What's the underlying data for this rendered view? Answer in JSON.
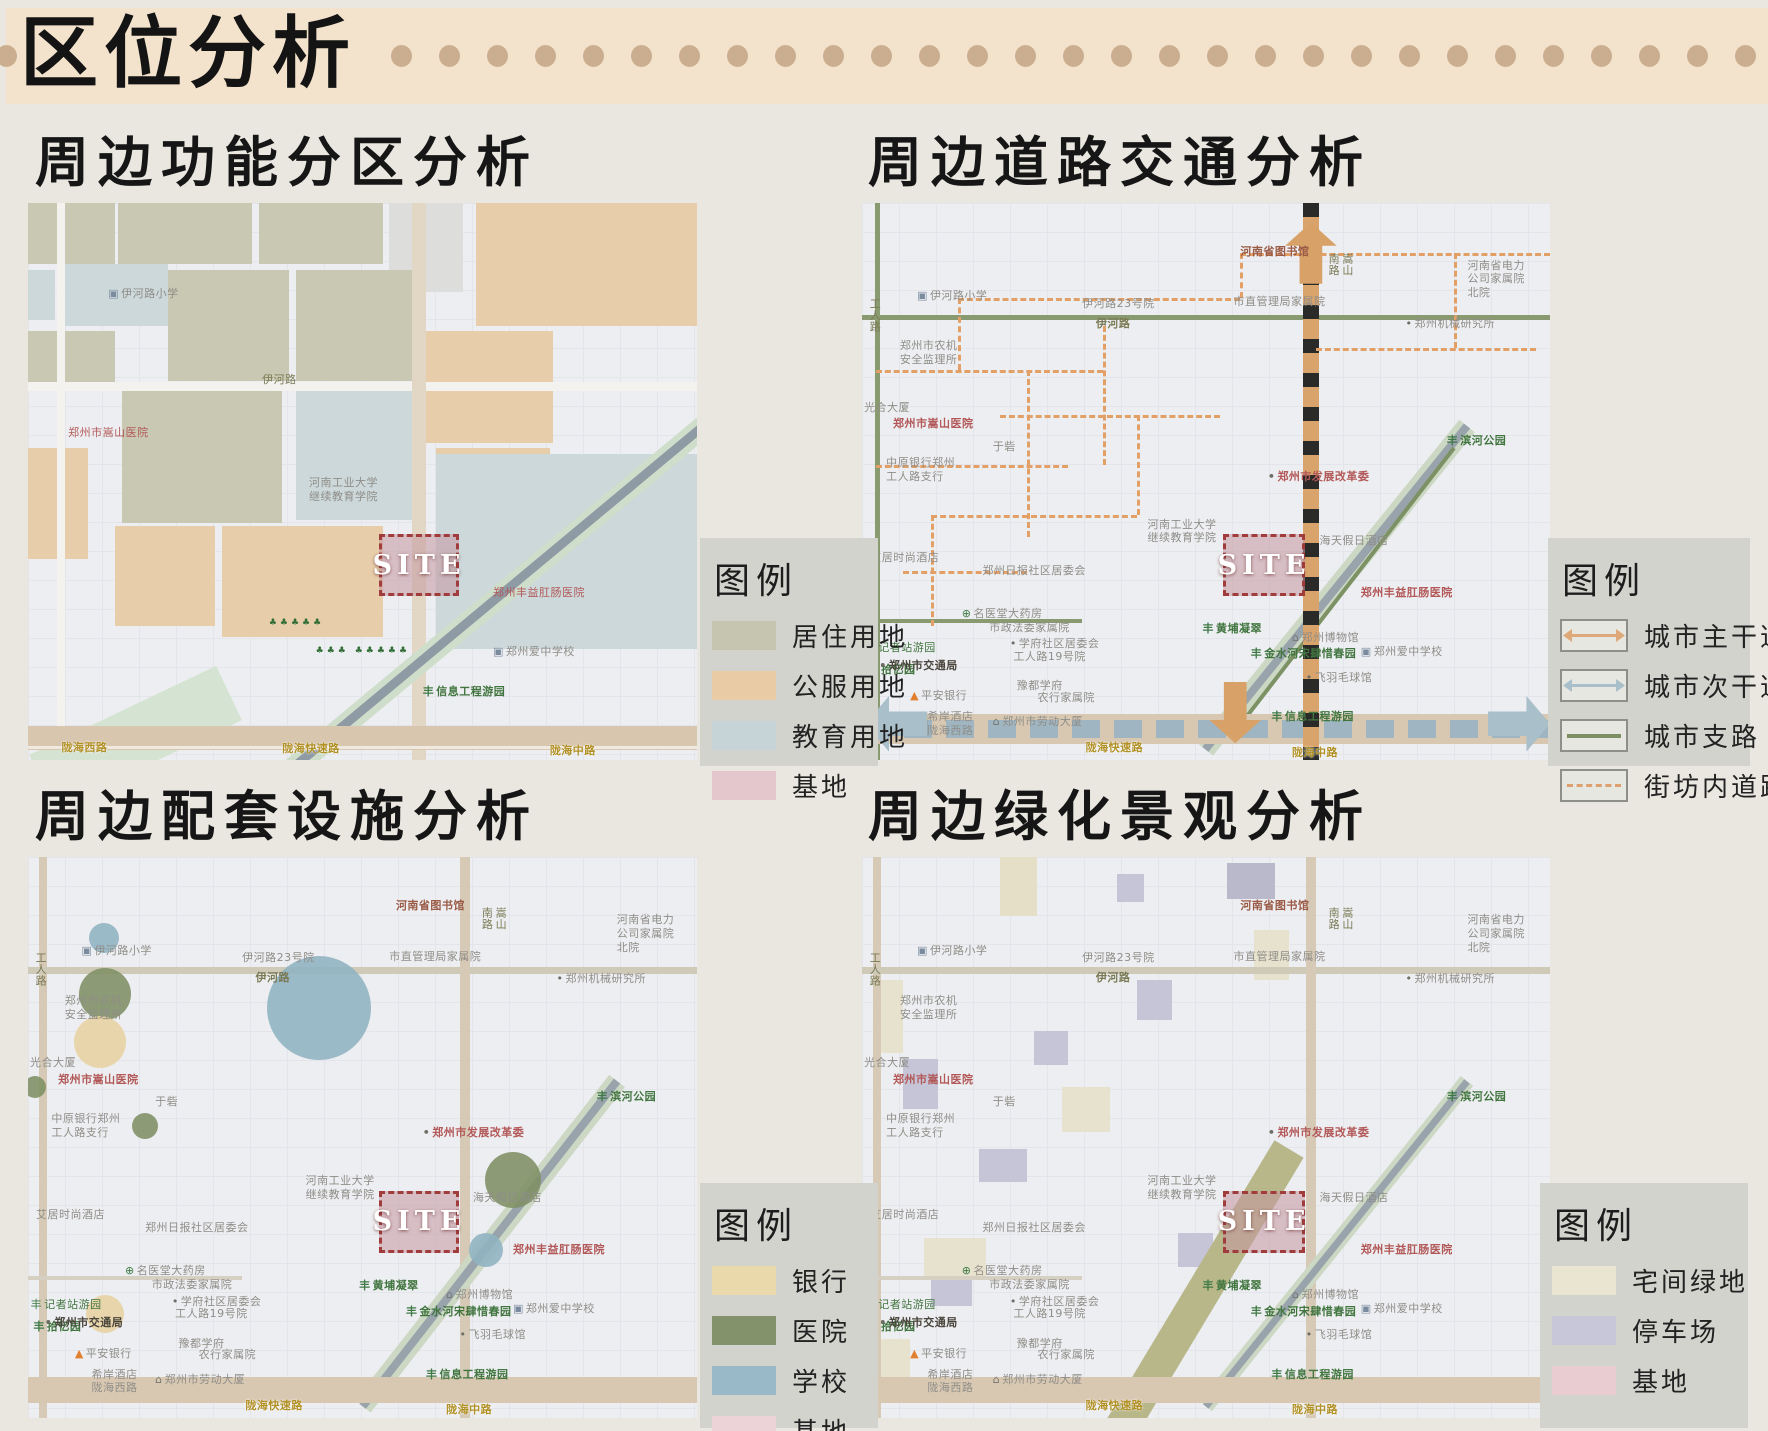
{
  "header": {
    "title": "区位分析",
    "dot_count": 29
  },
  "site_label": "SITE",
  "panels": [
    {
      "key": "function",
      "heading": "周边功能分区分析",
      "legend": {
        "title": "图例",
        "items": [
          {
            "label": "居住用地",
            "kind": "swatch",
            "color": "#c6c5b0"
          },
          {
            "label": "公服用地",
            "kind": "swatch",
            "color": "#e9cba6"
          },
          {
            "label": "教育用地",
            "kind": "swatch",
            "color": "#c6d4d7"
          },
          {
            "label": "基地",
            "kind": "swatch",
            "color": "#e4c7cc"
          }
        ]
      }
    },
    {
      "key": "traffic",
      "heading": "周边道路交通分析",
      "legend": {
        "title": "图例",
        "items": [
          {
            "label": "城市主干道",
            "kind": "arrow",
            "color": "#dfa878"
          },
          {
            "label": "城市次干道",
            "kind": "arrow",
            "color": "#a9bfca"
          },
          {
            "label": "城市支路",
            "kind": "line",
            "color": "#7d8f62"
          },
          {
            "label": "街坊内道路",
            "kind": "dash",
            "color": "#dfa070"
          }
        ]
      }
    },
    {
      "key": "facilities",
      "heading": "周边配套设施分析",
      "legend": {
        "title": "图例",
        "items": [
          {
            "label": "银行",
            "kind": "swatch",
            "color": "#ead9ab"
          },
          {
            "label": "医院",
            "kind": "swatch",
            "color": "#83926a"
          },
          {
            "label": "学校",
            "kind": "swatch",
            "color": "#9ab9c8"
          },
          {
            "label": "基地",
            "kind": "swatch",
            "color": "#ecd3d8"
          }
        ]
      }
    },
    {
      "key": "landscape",
      "heading": "周边绿化景观分析",
      "legend": {
        "title": "图例",
        "items": [
          {
            "label": "宅间绿地",
            "kind": "swatch",
            "color": "#e9e5d0"
          },
          {
            "label": "停车场",
            "kind": "swatch",
            "color": "#c7c7d9"
          },
          {
            "label": "基地",
            "kind": "swatch",
            "color": "#e8ccd2"
          }
        ]
      }
    }
  ],
  "icon_glyphs": {
    "tree-icon": {
      "ch": "丰",
      "color": "#3f7a46"
    },
    "bank-icon": {
      "ch": "▲",
      "color": "#e07f2e"
    },
    "med-icon": {
      "ch": "⊕",
      "color": "#3f7a46"
    },
    "dot-icon": {
      "ch": "•",
      "color": "#6f6c66"
    },
    "school-icon": {
      "ch": "▣",
      "color": "#7a8ba0"
    },
    "museum-icon": {
      "ch": "⌂",
      "color": "#77746e"
    }
  },
  "facility_colors": {
    "银行": "#e7d2a0",
    "医院": "#7e9063",
    "学校": "#8fb3c2"
  },
  "base_labels": [
    {
      "t": "河南省图书馆",
      "x": 55,
      "y": 7.5,
      "k": "brown",
      "b": 1
    },
    {
      "t": "河南省电力\n公司家属院\n北院",
      "x": 88,
      "y": 10
    },
    {
      "t": "伊河路小学",
      "x": 8,
      "y": 15.5,
      "icon": "school-icon"
    },
    {
      "t": "市直管理局家属院",
      "x": 54,
      "y": 16.5
    },
    {
      "t": "伊河路23号院",
      "x": 32,
      "y": 16.8
    },
    {
      "t": "郑州市农机\n安全监理所",
      "x": 5.5,
      "y": 24.5
    },
    {
      "t": "伊河路",
      "x": 34,
      "y": 20.4,
      "k": "olive",
      "b": 1
    },
    {
      "t": "郑州机械研究所",
      "x": 79,
      "y": 20.5,
      "icon": "dot-icon"
    },
    {
      "t": "工人路",
      "x": 0.8,
      "y": 17,
      "k": "olive",
      "v": 1
    },
    {
      "t": "嵩山\n南路",
      "x": 67.5,
      "y": 9,
      "k": "olive",
      "v": 1
    },
    {
      "t": "光合大厦",
      "x": 0.3,
      "y": 35.5
    },
    {
      "t": "郑州市嵩山医院",
      "x": 4.5,
      "y": 38.5,
      "k": "red",
      "b": 1
    },
    {
      "t": "于砦",
      "x": 19,
      "y": 42.5
    },
    {
      "t": "中原银行郑州\n工人路支行",
      "x": 3.5,
      "y": 45.5
    },
    {
      "t": "滨河公园",
      "x": 85,
      "y": 41.5,
      "k": "green",
      "b": 1,
      "icon": "tree-icon"
    },
    {
      "t": "郑州市发展改革委",
      "x": 59,
      "y": 48,
      "k": "red",
      "b": 1,
      "icon": "dot-icon"
    },
    {
      "t": "河南工业大学\n继续教育学院",
      "x": 41.5,
      "y": 56.5
    },
    {
      "t": "艾居时尚酒店",
      "x": 1.2,
      "y": 62.5
    },
    {
      "t": "郑州日报社区居委会",
      "x": 17.5,
      "y": 64.8
    },
    {
      "t": "名医堂大药房",
      "x": 14.5,
      "y": 72.5,
      "icon": "med-icon"
    },
    {
      "t": "学府社区居委会",
      "x": 21.5,
      "y": 78,
      "icon": "dot-icon"
    },
    {
      "t": "记者站游园",
      "x": 0.4,
      "y": 78.6,
      "k": "green",
      "icon": "tree-icon"
    },
    {
      "t": "拾忆园",
      "x": 0.8,
      "y": 82.6,
      "k": "green",
      "b": 1,
      "icon": "tree-icon"
    },
    {
      "t": "豫都学府",
      "x": 22.5,
      "y": 85.5
    },
    {
      "t": "海天假日酒店",
      "x": 66.5,
      "y": 59.5
    },
    {
      "t": "郑州丰益肛肠医院",
      "x": 72.5,
      "y": 68.8,
      "k": "red",
      "b": 1
    },
    {
      "t": "市政法委家属院",
      "x": 18.5,
      "y": 75
    },
    {
      "t": "黄埔凝翠",
      "x": 49.5,
      "y": 75.2,
      "k": "green",
      "b": 1,
      "icon": "tree-icon"
    },
    {
      "t": "郑州博物馆",
      "x": 62.5,
      "y": 76.8,
      "icon": "museum-icon"
    },
    {
      "t": "金水河宋肆惜春园",
      "x": 56.5,
      "y": 79.8,
      "k": "green",
      "b": 1,
      "icon": "tree-icon"
    },
    {
      "t": "郑州爱中学校",
      "x": 72.5,
      "y": 79.3,
      "icon": "school-icon"
    },
    {
      "t": "飞羽毛球馆",
      "x": 64.5,
      "y": 84,
      "icon": "dot-icon"
    },
    {
      "t": "工人路19号院",
      "x": 22,
      "y": 80.2
    },
    {
      "t": "郑州市交通局",
      "x": 2.5,
      "y": 81.8,
      "k": "dark",
      "b": 1,
      "icon": "dot-icon"
    },
    {
      "t": "平安银行",
      "x": 7,
      "y": 87.3,
      "icon": "bank-icon"
    },
    {
      "t": "农行家属院",
      "x": 25.5,
      "y": 87.6
    },
    {
      "t": "希岸酒店\n陇海西路",
      "x": 9.5,
      "y": 91
    },
    {
      "t": "郑州市劳动大厦",
      "x": 19,
      "y": 92,
      "icon": "museum-icon"
    },
    {
      "t": "信息工程游园",
      "x": 59.5,
      "y": 91,
      "k": "green",
      "b": 1,
      "icon": "tree-icon"
    },
    {
      "t": "陇海快速路",
      "x": 32.5,
      "y": 96.6,
      "k": "gold",
      "b": 1
    },
    {
      "t": "陇海中路",
      "x": 62.5,
      "y": 97.4,
      "k": "gold",
      "b": 1
    }
  ],
  "maps": {
    "function": {
      "blocks": [
        {
          "x": 0,
          "y": 0,
          "w": 13,
          "h": 11,
          "c": "#c9c8b2"
        },
        {
          "x": 13.5,
          "y": 0,
          "w": 20,
          "h": 11,
          "c": "#c9c8b2"
        },
        {
          "x": 34.5,
          "y": 0,
          "w": 18.5,
          "h": 11,
          "c": "#c9c8b2"
        },
        {
          "x": 54,
          "y": 0,
          "w": 11,
          "h": 16,
          "c": "#dddedb"
        },
        {
          "x": 67,
          "y": 0,
          "w": 33,
          "h": 22,
          "c": "#e7cdaa"
        },
        {
          "x": 4.5,
          "y": 11,
          "w": 16.5,
          "h": 11,
          "c": "#ccd8da"
        },
        {
          "x": 0,
          "y": 12,
          "w": 4,
          "h": 9,
          "c": "#ccd8da"
        },
        {
          "x": 21,
          "y": 12,
          "w": 18,
          "h": 20,
          "c": "#c9c8b2"
        },
        {
          "x": 40,
          "y": 12,
          "w": 18,
          "h": 20,
          "c": "#c9c8b2"
        },
        {
          "x": 0,
          "y": 23,
          "w": 13,
          "h": 10,
          "c": "#c9c8b2"
        },
        {
          "x": 58.5,
          "y": 23,
          "w": 20,
          "h": 20,
          "c": "#e7cdaa"
        },
        {
          "x": 14,
          "y": 33.5,
          "w": 24,
          "h": 24,
          "c": "#c9c8b2"
        },
        {
          "x": 40,
          "y": 33,
          "w": 19,
          "h": 24,
          "c": "#ccd8da"
        },
        {
          "x": 0,
          "y": 44,
          "w": 9,
          "h": 20,
          "c": "#e7cdaa"
        },
        {
          "x": 61,
          "y": 44,
          "w": 17,
          "h": 14,
          "c": "#e7cdaa"
        },
        {
          "x": 61,
          "y": 45,
          "w": 39,
          "h": 35,
          "c": "#ccd8da"
        },
        {
          "x": 13,
          "y": 58,
          "w": 15,
          "h": 18,
          "c": "#e7cdaa"
        },
        {
          "x": 29,
          "y": 58,
          "w": 24,
          "h": 20,
          "c": "#e7cdaa"
        }
      ],
      "roads": [
        {
          "d": "v",
          "x": 5,
          "th": 8,
          "c": "#f3f2ee"
        },
        {
          "d": "h",
          "y": 33,
          "th": 9,
          "c": "#f3f2ee"
        },
        {
          "d": "v",
          "x": 58.5,
          "th": 14,
          "c": "#e2d7c5"
        },
        {
          "d": "diag",
          "x1": 30,
          "y1": 88,
          "x2": 2,
          "y2": 104,
          "th": 60,
          "c": "#d5e3d2"
        },
        {
          "d": "diag",
          "x1": 101,
          "y1": 40,
          "x2": 38,
          "y2": 103,
          "th": 22,
          "c": "#cfdecb"
        },
        {
          "d": "diag",
          "x1": 101,
          "y1": 40,
          "x2": 38,
          "y2": 103,
          "th": 9,
          "c": "#8e9aa4"
        },
        {
          "d": "h",
          "y": 96,
          "th": 24,
          "c": "#d8c6ae"
        },
        {
          "d": "h",
          "y": 97.8,
          "th": 3,
          "c": "#efe9df"
        }
      ],
      "labels": [
        {
          "t": "伊河路小学",
          "x": 12,
          "y": 15,
          "icon": "school-icon"
        },
        {
          "t": "伊河路",
          "x": 35,
          "y": 30.5,
          "k": "olive"
        },
        {
          "t": "郑州市嵩山医院",
          "x": 6,
          "y": 40,
          "k": "red"
        },
        {
          "t": "河南工业大学\n继续教育学院",
          "x": 42,
          "y": 49
        },
        {
          "t": "郑州丰益肛肠医院",
          "x": 69.5,
          "y": 68.8,
          "k": "red"
        },
        {
          "t": "郑州爱中学校",
          "x": 69.5,
          "y": 79.3,
          "icon": "school-icon"
        },
        {
          "t": "信息工程游园",
          "x": 59,
          "y": 86.5,
          "k": "green",
          "b": 1,
          "icon": "tree-icon"
        },
        {
          "t": "♣♣♣♣♣",
          "x": 36,
          "y": 74.5,
          "k": "trees"
        },
        {
          "t": "♣♣♣ ♣♣♣♣♣",
          "x": 43,
          "y": 79.5,
          "k": "trees"
        },
        {
          "t": "陇海西路",
          "x": 5,
          "y": 96.6,
          "k": "gold",
          "b": 1
        },
        {
          "t": "陇海快速路",
          "x": 38,
          "y": 96.8,
          "k": "gold",
          "b": 1
        },
        {
          "t": "陇海中路",
          "x": 78,
          "y": 97.2,
          "k": "gold",
          "b": 1
        }
      ],
      "site": {
        "x": 52.5,
        "y": 59.5,
        "w": 11,
        "h": 10
      }
    },
    "traffic": {
      "roads": [
        {
          "d": "v",
          "x": 2.2,
          "th": 5,
          "c": "#8a9a70"
        },
        {
          "d": "h",
          "y": 20.6,
          "th": 5,
          "c": "#8a9a70"
        },
        {
          "d": "h",
          "y": 75,
          "x1": 0,
          "x2": 32,
          "th": 4,
          "c": "#8a9a70"
        },
        {
          "d": "diag",
          "x1": 88,
          "y1": 40,
          "x2": 50,
          "y2": 98,
          "th": 20,
          "c": "#ccd8c4"
        },
        {
          "d": "diag",
          "x1": 88,
          "y1": 40,
          "x2": 50,
          "y2": 98,
          "th": 8,
          "c": "#98a3ac"
        },
        {
          "d": "diag",
          "x1": 86,
          "y1": 44,
          "x2": 56,
          "y2": 92,
          "th": 4,
          "c": "#7c9164"
        },
        {
          "d": "h",
          "y": 94.5,
          "th": 30,
          "c": "#d8c8b2"
        },
        {
          "d": "h",
          "y": 94.5,
          "th": 18,
          "cls": "pattern-h"
        },
        {
          "d": "v",
          "x": 65.3,
          "th": 16,
          "cls": "pattern-v"
        }
      ],
      "dashes": [
        {
          "d": "h",
          "y": 9,
          "x1": 55,
          "x2": 100
        },
        {
          "d": "v",
          "x": 55,
          "y1": 9,
          "y2": 17
        },
        {
          "d": "h",
          "y": 17,
          "x1": 14,
          "x2": 55
        },
        {
          "d": "v",
          "x": 14,
          "y1": 17,
          "y2": 30
        },
        {
          "d": "h",
          "y": 30,
          "x1": 2,
          "x2": 35
        },
        {
          "d": "v",
          "x": 35,
          "y1": 22,
          "y2": 47
        },
        {
          "d": "h",
          "y": 38,
          "x1": 20,
          "x2": 52
        },
        {
          "d": "v",
          "x": 24,
          "y1": 30,
          "y2": 60
        },
        {
          "d": "h",
          "y": 47,
          "x1": 2,
          "x2": 30
        },
        {
          "d": "h",
          "y": 56,
          "x1": 10,
          "x2": 40
        },
        {
          "d": "v",
          "x": 40,
          "y1": 38,
          "y2": 56
        },
        {
          "d": "h",
          "y": 26,
          "x1": 66,
          "x2": 98
        },
        {
          "d": "v",
          "x": 86,
          "y1": 9,
          "y2": 26
        },
        {
          "d": "h",
          "y": 66,
          "x1": 6,
          "x2": 24
        },
        {
          "d": "v",
          "x": 10,
          "y1": 56,
          "y2": 76
        }
      ],
      "arrows": [
        {
          "dir": "up",
          "x": 61.5,
          "y": 3.5,
          "w": 7.5,
          "h": 11,
          "c": "#d8a168"
        },
        {
          "dir": "down",
          "x": 50.5,
          "y": 86,
          "w": 7.5,
          "h": 11,
          "c": "#d8a168"
        },
        {
          "dir": "left",
          "x": 0.5,
          "y": 88.5,
          "w": 9,
          "h": 10,
          "c": "#a9bfca"
        },
        {
          "dir": "right",
          "x": 91,
          "y": 88.5,
          "w": 9,
          "h": 10,
          "c": "#a9bfca"
        }
      ],
      "labels": "base",
      "site": {
        "x": 52.5,
        "y": 59.5,
        "w": 11,
        "h": 10
      }
    },
    "facilities": {
      "roads": [
        {
          "d": "v",
          "x": 2.2,
          "th": 8,
          "c": "#d6cab6"
        },
        {
          "d": "h",
          "y": 20.2,
          "th": 7,
          "c": "#cfc9b8"
        },
        {
          "d": "v",
          "x": 65.3,
          "th": 10,
          "c": "#d6cab6"
        },
        {
          "d": "h",
          "y": 75,
          "x1": 0,
          "x2": 32,
          "th": 4,
          "c": "#d5d0c2"
        },
        {
          "d": "diag",
          "x1": 88,
          "y1": 40,
          "x2": 50,
          "y2": 98,
          "th": 20,
          "c": "#ccd8c4"
        },
        {
          "d": "diag",
          "x1": 88,
          "y1": 40,
          "x2": 50,
          "y2": 98,
          "th": 8,
          "c": "#98a3ac"
        },
        {
          "d": "h",
          "y": 95,
          "th": 26,
          "c": "#d8c8b2"
        }
      ],
      "circles": [
        {
          "cat": "学校",
          "x": 11.3,
          "y": 14.4,
          "r": 15
        },
        {
          "cat": "医院",
          "x": 11.5,
          "y": 24.5,
          "r": 26
        },
        {
          "cat": "银行",
          "x": 10.8,
          "y": 33,
          "r": 26
        },
        {
          "cat": "学校",
          "x": 43.5,
          "y": 27,
          "r": 52
        },
        {
          "cat": "医院",
          "x": 1,
          "y": 41,
          "r": 11
        },
        {
          "cat": "医院",
          "x": 17.5,
          "y": 48,
          "r": 13
        },
        {
          "cat": "医院",
          "x": 72.5,
          "y": 57.5,
          "r": 28
        },
        {
          "cat": "学校",
          "x": 68.5,
          "y": 70,
          "r": 17
        },
        {
          "cat": "银行",
          "x": 11.5,
          "y": 81.5,
          "r": 19
        }
      ],
      "labels": "base",
      "site": {
        "x": 52.5,
        "y": 59.5,
        "w": 11,
        "h": 10
      }
    },
    "landscape": {
      "rects": [
        {
          "x": 20,
          "y": 0,
          "w": 5.5,
          "h": 10.5,
          "c": "#e6dfc8"
        },
        {
          "x": 37,
          "y": 3,
          "w": 4,
          "h": 5,
          "c": "#c5c5d7"
        },
        {
          "x": 53,
          "y": 1,
          "w": 7,
          "h": 6.5,
          "c": "#b9b9cb"
        },
        {
          "x": 2,
          "y": 22,
          "w": 4,
          "h": 13,
          "c": "#e6e2cd"
        },
        {
          "x": 57,
          "y": 13,
          "w": 5,
          "h": 9,
          "c": "#e6e2cd"
        },
        {
          "x": 40,
          "y": 22,
          "w": 5,
          "h": 7,
          "c": "#c5c5d7"
        },
        {
          "x": 25,
          "y": 31,
          "w": 5,
          "h": 6,
          "c": "#c5c5d7"
        },
        {
          "x": 6,
          "y": 36,
          "w": 5,
          "h": 9,
          "c": "#c5c5d7"
        },
        {
          "x": 29,
          "y": 41,
          "w": 7,
          "h": 8,
          "c": "#e6e2cd"
        },
        {
          "x": 17,
          "y": 52,
          "w": 7,
          "h": 6,
          "c": "#c5c5d7"
        },
        {
          "x": 46,
          "y": 67,
          "w": 5,
          "h": 6,
          "c": "#c5c5d7"
        },
        {
          "x": 9,
          "y": 68,
          "w": 9,
          "h": 7,
          "c": "#e6e2cd"
        },
        {
          "x": 10,
          "y": 75,
          "w": 6,
          "h": 5,
          "c": "#c5c5d7"
        },
        {
          "x": 0,
          "y": 86,
          "w": 7,
          "h": 8,
          "c": "#e6e2cd"
        }
      ],
      "roads": [
        {
          "d": "v",
          "x": 2.2,
          "th": 8,
          "c": "#d6cab6"
        },
        {
          "d": "h",
          "y": 20.2,
          "th": 7,
          "c": "#cfc9b8"
        },
        {
          "d": "v",
          "x": 65.3,
          "th": 10,
          "c": "#d6cab6"
        },
        {
          "d": "h",
          "y": 75,
          "x1": 0,
          "x2": 32,
          "th": 4,
          "c": "#d5d0c2"
        },
        {
          "d": "diag",
          "x1": 62,
          "y1": 52,
          "x2": 37,
          "y2": 103,
          "th": 34,
          "c": "#b8b78a"
        },
        {
          "d": "diag",
          "x1": 88,
          "y1": 40,
          "x2": 50,
          "y2": 98,
          "th": 16,
          "c": "#ccd8c4"
        },
        {
          "d": "diag",
          "x1": 88,
          "y1": 40,
          "x2": 50,
          "y2": 98,
          "th": 7,
          "c": "#98a3ac"
        },
        {
          "d": "h",
          "y": 95,
          "th": 26,
          "c": "#d8c8b2"
        }
      ],
      "labels": "base",
      "site": {
        "x": 52.5,
        "y": 59.5,
        "w": 11,
        "h": 10
      }
    }
  }
}
